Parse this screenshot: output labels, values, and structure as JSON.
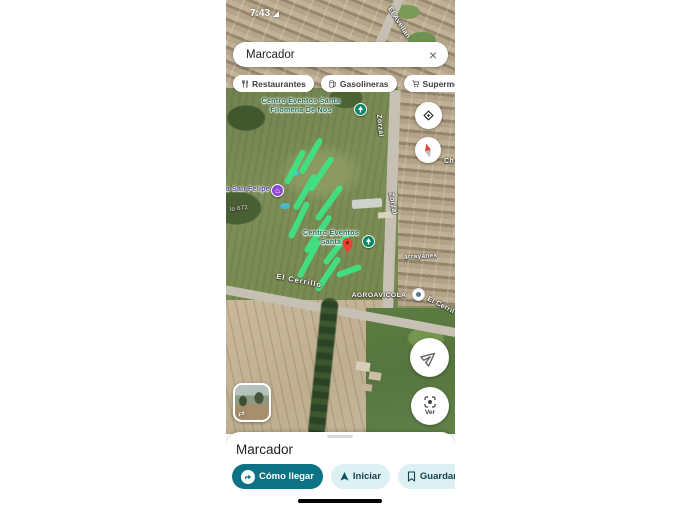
{
  "status_bar": {
    "time": "7:43"
  },
  "search": {
    "value": "Marcador"
  },
  "chips": [
    {
      "label": "Restaurantes",
      "icon": "restaurant-icon"
    },
    {
      "label": "Gasolineras",
      "icon": "gas-station-icon"
    },
    {
      "label": "Supermercados",
      "icon": "supermarket-icon"
    }
  ],
  "map": {
    "pois": {
      "eventos_top": {
        "line1": "Centro Eventos Santa",
        "line2": "Filomena De Nos"
      },
      "eventos_mid": {
        "line1": "Centro Eventos",
        "line2": "Santa"
      },
      "san_felipe": {
        "label": "a San Felipe"
      },
      "agroavicola": {
        "label": "AGROAVICOLA"
      }
    },
    "streets": {
      "avellano": "El Avellan",
      "zorzal_upper": "Zorzal",
      "zorzal_lower": "Zorzal",
      "cerrillo": "El Cerrillo",
      "cerrillo_right": "El Cerril",
      "arrayanes": "arrayanes",
      "lot_number": "lo 672",
      "ch": "Ch"
    },
    "controls": {
      "ver_label": "Ver"
    }
  },
  "bottom_sheet": {
    "title": "Marcador",
    "actions": [
      {
        "label": "Cómo llegar"
      },
      {
        "label": "Iniciar"
      },
      {
        "label": "Guardar"
      }
    ]
  },
  "colors": {
    "accent_teal": "#0d7284",
    "light_action_bg": "#ddf1f5",
    "highlight_green": "#3fe283",
    "pin_teal": "#0c8766",
    "pin_purple": "#8e4bd0",
    "marker_red": "#ea4335"
  }
}
